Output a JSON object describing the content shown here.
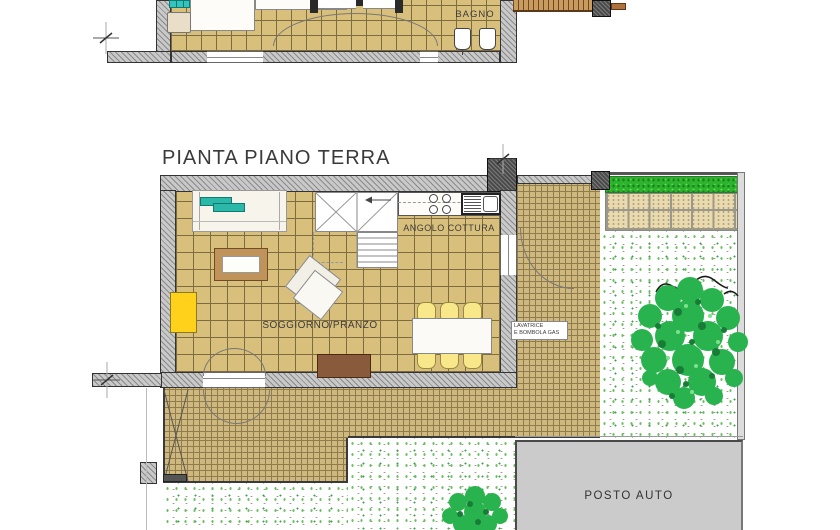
{
  "title": "PIANTA PIANO TERRA",
  "upper_plan": {
    "bagno_label": "BAGNO"
  },
  "ground_plan": {
    "kitchen_label": "ANGOLO COTTURA",
    "living_label": "SOGGIORNO/PRANZO",
    "laundry_label_line1": "LAVATRICE",
    "laundry_label_line2": "E BOMBOLA GAS",
    "parking_label": "POSTO AUTO"
  },
  "colors": {
    "tile_tan": "#d8c07c",
    "wall_gray": "#c9c9c9",
    "teal_fixture": "#35c4bc",
    "yellow_cabinet": "#ffd11a",
    "wood_brown": "#8a5a3c",
    "grass_green": "#2db32d",
    "tree_green": "#29b34e",
    "paver_beige": "#e8dab2",
    "parking_gray": "#cbcbcb"
  }
}
